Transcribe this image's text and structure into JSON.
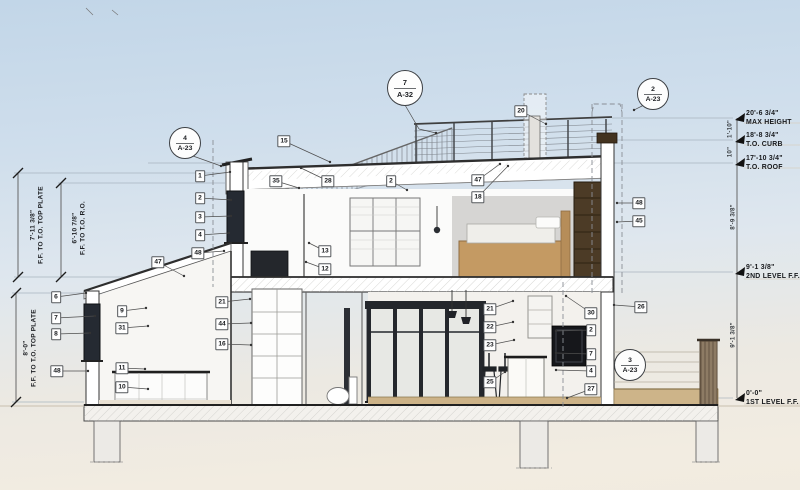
{
  "drawing": {
    "type": "building-cross-section",
    "colors": {
      "sky_top": "#c2d6e8",
      "ground_warm": "#f2ece1",
      "line_dark": "#333333",
      "window_dark": "#252a32",
      "wood_bed": "#c49a63",
      "wardrobe_brown": "#4c3b26",
      "patio_tan": "#cdb489",
      "tag_border": "#55585c"
    }
  },
  "callouts": [
    {
      "num": "7",
      "sheet": "A-32",
      "x": 405,
      "y": 88,
      "size": 34,
      "leader": [
        [
          405,
          105
        ],
        [
          419,
          129
        ],
        [
          436,
          133
        ]
      ]
    },
    {
      "num": "4",
      "sheet": "A-23",
      "x": 185,
      "y": 143,
      "size": 30,
      "leader": [
        [
          193,
          156
        ],
        [
          221,
          166
        ]
      ]
    },
    {
      "num": "2",
      "sheet": "A-23",
      "x": 653,
      "y": 94,
      "size": 30,
      "leader": [
        [
          644,
          105
        ],
        [
          634,
          110
        ]
      ]
    },
    {
      "num": "3",
      "sheet": "A-23",
      "x": 630,
      "y": 365,
      "size": 30,
      "leader": null
    }
  ],
  "tags": [
    {
      "label": "1",
      "x": 200,
      "y": 176,
      "lx": 230,
      "ly": 172
    },
    {
      "label": "2",
      "x": 200,
      "y": 198,
      "lx": 231,
      "ly": 200
    },
    {
      "label": "3",
      "x": 200,
      "y": 217,
      "lx": 231,
      "ly": 216
    },
    {
      "label": "4",
      "x": 200,
      "y": 235,
      "lx": 229,
      "ly": 233
    },
    {
      "label": "48",
      "x": 198,
      "y": 253,
      "lx": 224,
      "ly": 251
    },
    {
      "label": "47",
      "x": 158,
      "y": 262,
      "lx": 184,
      "ly": 276
    },
    {
      "label": "15",
      "x": 284,
      "y": 141,
      "lx": 330,
      "ly": 162
    },
    {
      "label": "35",
      "x": 276,
      "y": 181,
      "lx": 299,
      "ly": 188
    },
    {
      "label": "28",
      "x": 328,
      "y": 181,
      "lx": 301,
      "ly": 168
    },
    {
      "label": "2",
      "x": 391,
      "y": 181,
      "lx": 407,
      "ly": 190
    },
    {
      "label": "13",
      "x": 325,
      "y": 251,
      "lx": 309,
      "ly": 243
    },
    {
      "label": "12",
      "x": 325,
      "y": 269,
      "lx": 306,
      "ly": 262
    },
    {
      "label": "20",
      "x": 521,
      "y": 111,
      "lx": 546,
      "ly": 124
    },
    {
      "label": "47",
      "x": 478,
      "y": 180,
      "lx": 500,
      "ly": 164
    },
    {
      "label": "18",
      "x": 478,
      "y": 197,
      "lx": 508,
      "ly": 166
    },
    {
      "label": "48",
      "x": 639,
      "y": 203,
      "lx": 617,
      "ly": 203
    },
    {
      "label": "45",
      "x": 639,
      "y": 221,
      "lx": 617,
      "ly": 222
    },
    {
      "label": "6",
      "x": 56,
      "y": 297,
      "lx": 86,
      "ly": 293
    },
    {
      "label": "7",
      "x": 56,
      "y": 318,
      "lx": 95,
      "ly": 316
    },
    {
      "label": "8",
      "x": 56,
      "y": 334,
      "lx": 90,
      "ly": 333
    },
    {
      "label": "48",
      "x": 57,
      "y": 371,
      "lx": 88,
      "ly": 371
    },
    {
      "label": "9",
      "x": 122,
      "y": 311,
      "lx": 146,
      "ly": 308
    },
    {
      "label": "31",
      "x": 122,
      "y": 328,
      "lx": 148,
      "ly": 326
    },
    {
      "label": "11",
      "x": 122,
      "y": 368,
      "lx": 145,
      "ly": 369
    },
    {
      "label": "10",
      "x": 122,
      "y": 387,
      "lx": 148,
      "ly": 389
    },
    {
      "label": "21",
      "x": 222,
      "y": 302,
      "lx": 250,
      "ly": 299
    },
    {
      "label": "44",
      "x": 222,
      "y": 324,
      "lx": 251,
      "ly": 323
    },
    {
      "label": "16",
      "x": 222,
      "y": 344,
      "lx": 251,
      "ly": 345
    },
    {
      "label": "21",
      "x": 490,
      "y": 309,
      "lx": 513,
      "ly": 301
    },
    {
      "label": "22",
      "x": 490,
      "y": 327,
      "lx": 513,
      "ly": 322
    },
    {
      "label": "23",
      "x": 490,
      "y": 345,
      "lx": 514,
      "ly": 340
    },
    {
      "label": "25",
      "x": 490,
      "y": 382,
      "lx": 505,
      "ly": 372
    },
    {
      "label": "30",
      "x": 591,
      "y": 313,
      "lx": 566,
      "ly": 296
    },
    {
      "label": "26",
      "x": 641,
      "y": 307,
      "lx": 614,
      "ly": 305
    },
    {
      "label": "2",
      "x": 591,
      "y": 330,
      "lx": 556,
      "ly": 331
    },
    {
      "label": "7",
      "x": 591,
      "y": 354,
      "lx": 556,
      "ly": 353
    },
    {
      "label": "4",
      "x": 591,
      "y": 371,
      "lx": 556,
      "ly": 370
    },
    {
      "label": "27",
      "x": 591,
      "y": 389,
      "lx": 567,
      "ly": 398
    }
  ],
  "right_labels": [
    {
      "dim": "20'-6 3/4\"",
      "name": "MAX HEIGHT",
      "y": 118
    },
    {
      "dim": "18'-8 3/4\"",
      "name": "T.O. CURB",
      "y": 140
    },
    {
      "dim": "17'-10 3/4\"",
      "name": "T.O. ROOF",
      "y": 163
    },
    {
      "dim": "9'-1 3/8\"",
      "name": "2ND LEVEL F.F.",
      "y": 272
    },
    {
      "dim": "0'-0\"",
      "name": "1ST LEVEL F.F.",
      "y": 398
    }
  ],
  "right_vertical_dims": [
    {
      "label": "1'-10\"",
      "x": 730,
      "y": 129
    },
    {
      "label": "10\"",
      "x": 730,
      "y": 152
    },
    {
      "label": "8'-9 3/8\"",
      "x": 733,
      "y": 217
    },
    {
      "label": "9'-1 3/8\"",
      "x": 733,
      "y": 335
    }
  ],
  "left_dims": [
    {
      "dim": "7'-11 3/8\"",
      "name": "F.F. TO T.O. TOP PLATE",
      "x": 38,
      "y": 225
    },
    {
      "dim": "6'-10 7/8\"",
      "name": "F.F. TO T.O. R.O.",
      "x": 80,
      "y": 228
    },
    {
      "dim": "8'-0\"",
      "name": "F.F. TO T.O. TOP PLATE",
      "x": 31,
      "y": 348
    }
  ]
}
